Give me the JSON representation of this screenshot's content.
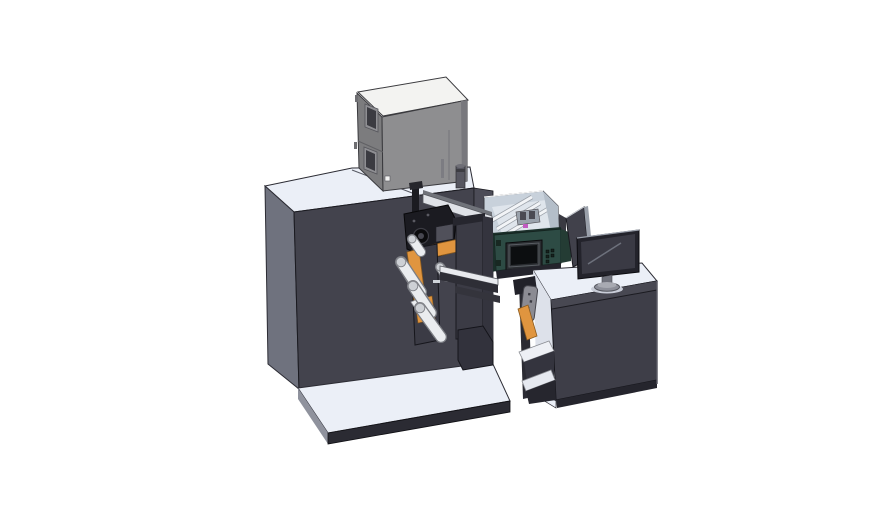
{
  "meta": {
    "width": 888,
    "height": 522,
    "background": "#ffffff",
    "description": "Isometric 3D CAD rendering of an industrial label printing and rewinding machine: large dark cabinet with unwind rollers and print mechanism, gray electronics enclosure on top, teal HMI control box with touchscreen under a transparent hood, and an operator desk with a monitor on the right"
  },
  "colors": {
    "bg": "#ffffff",
    "white_top": "#ebeff7",
    "box_top": "#f3f3f1",
    "left_face": "#6f727e",
    "machine_front": "#43434d",
    "machine_right": "#4c4c57",
    "base_left": "#8f929d",
    "dark_strip": "#2b2b33",
    "box_left": "#7c7c7e",
    "box_front": "#8e8e90",
    "box_edge": "#78787d",
    "window": "#3b3b41",
    "window_frame": "#8f8f93",
    "orange": "#e0953f",
    "orange_dark": "#8a5a1e",
    "roller": "#eaecef",
    "roller_cap": "#cdd0d5",
    "roller_edge": "#85878d",
    "black_part": "#1b1b21",
    "gray_part": "#50505a",
    "plate": "#3b3b45",
    "plate_dark": "#26262e",
    "column": "#32323c",
    "wedge": "#eceef1",
    "enclosure": "#c8d1db",
    "enclosure_floor": "#dfe5ec",
    "enclosure_wall": "#b4bec9",
    "teal": "#2d4b44",
    "teal_dark": "#1b2f2a",
    "screen_frame": "#2a2d31",
    "screen": "#0c0e10",
    "magenta": "#c05ac0",
    "silver": "#dfe2e7",
    "desk_front": "#3e3e48",
    "desk_band": "#484852",
    "desk_light_side": "#dde1ea",
    "monitor_bezel": "#23232b",
    "monitor_screen": "#3a3a44",
    "stand": "#8d8f99",
    "stand_light": "#a8aab2",
    "shadow": "#c9cdd8",
    "device_gray": "#8b8b93"
  },
  "components": {
    "machine_cabinet": "main machine cabinet",
    "electronics_box": "electronics enclosure on top",
    "inspection_windows": "two dark inspection windows",
    "filter_cylinder": "small cylinder vent",
    "print_mechanism": "black print head mechanism",
    "unwind_rollers": "white web guide rollers",
    "orange_guards": "orange guard plates",
    "transparent_hood": "transparent hood with slide rails",
    "hmi_panel": "teal HMI control box with touchscreen",
    "base_platform": "white machine base platform",
    "operator_desk": "operator desk cabinet",
    "desk_shelf": "open side shelf of desk",
    "handheld_device": "gray handheld device on shelf",
    "monitor": "desktop monitor on stand",
    "side_panel": "tilted dark side panel"
  }
}
